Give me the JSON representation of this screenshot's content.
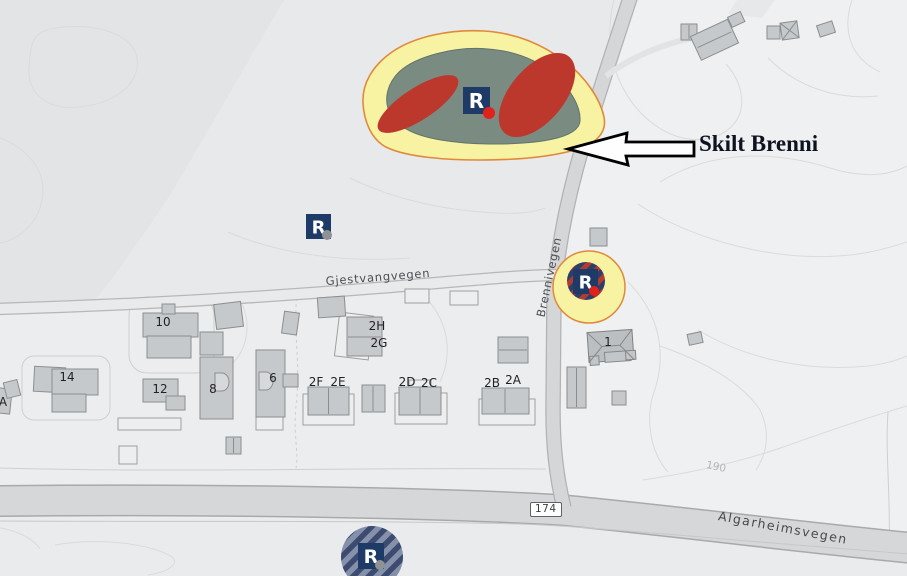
{
  "annotation": {
    "label": "Skilt Brenni"
  },
  "roads": {
    "gjestvangvegen": "Gjestvangvegen",
    "brennivegen": "Brennivegen",
    "algarheimsvegen": "Algarheimsvegen",
    "route_number": "174"
  },
  "terrain": {
    "contour_elevation": "190"
  },
  "houses": {
    "h10": "10",
    "h14": "14",
    "h12": "12",
    "hA": "A",
    "h8": "8",
    "h6": "6",
    "h2H": "2H",
    "h2G": "2G",
    "h2F": "2F",
    "h2E": "2E",
    "h2D": "2D",
    "h2C": "2C",
    "h2B": "2B",
    "h2A": "2A",
    "h1": "1"
  },
  "markers": {
    "letter": "R"
  },
  "colors": {
    "heritage_halo": "#f8f3a3",
    "heritage_outline": "#e0893b",
    "site_fill": "#7a8b82",
    "site_red": "#bc372c",
    "marker_blue": "#1e3a66",
    "dot_red": "#e3211c",
    "dot_gray": "#8f9294"
  }
}
